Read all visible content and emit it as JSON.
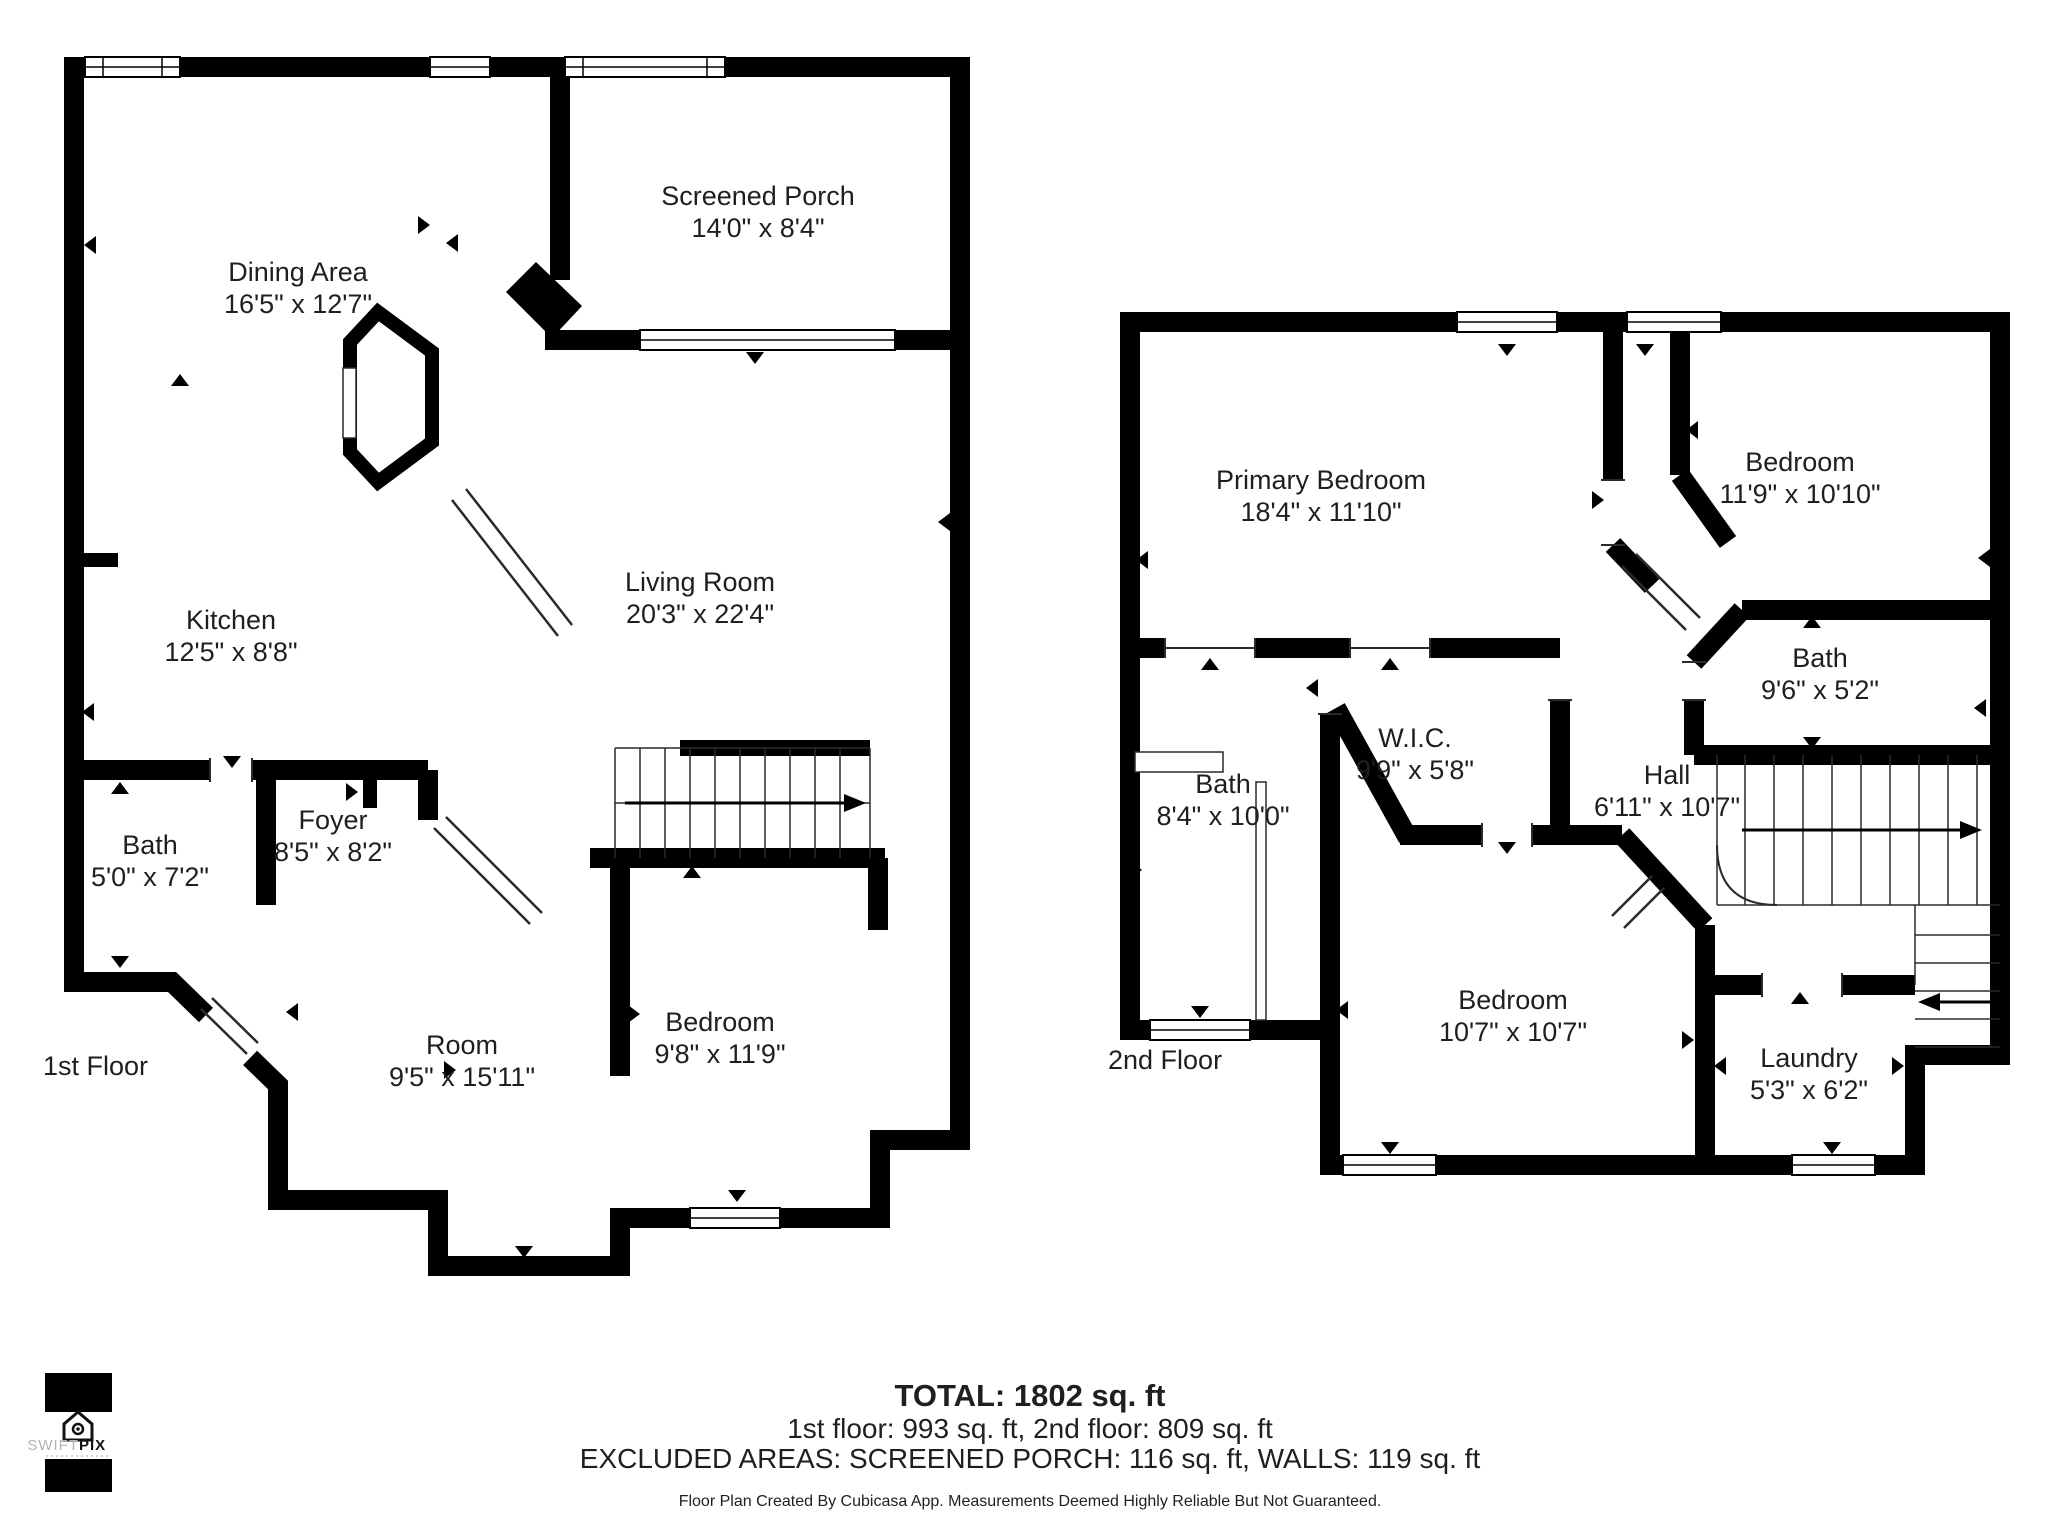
{
  "colors": {
    "wall": "#000000",
    "background": "#ffffff",
    "text": "#1f1f1f",
    "logo_light": "#b3b3b3"
  },
  "floors": [
    {
      "name": "1st Floor",
      "rooms": [
        {
          "label": "Dining Area",
          "dims": "16'5\" x 12'7\""
        },
        {
          "label": "Screened Porch",
          "dims": "14'0\" x 8'4\""
        },
        {
          "label": "Living Room",
          "dims": "20'3\" x 22'4\""
        },
        {
          "label": "Kitchen",
          "dims": "12'5\" x 8'8\""
        },
        {
          "label": "Bath",
          "dims": "5'0\" x 7'2\""
        },
        {
          "label": "Foyer",
          "dims": "8'5\" x 8'2\""
        },
        {
          "label": "Room",
          "dims": "9'5\" x 15'11\""
        },
        {
          "label": "Bedroom",
          "dims": "9'8\" x 11'9\""
        }
      ]
    },
    {
      "name": "2nd Floor",
      "rooms": [
        {
          "label": "Primary Bedroom",
          "dims": "18'4\" x 11'10\""
        },
        {
          "label": "Bedroom",
          "dims": "11'9\" x 10'10\""
        },
        {
          "label": "Bath",
          "dims": "9'6\" x 5'2\""
        },
        {
          "label": "W.I.C.",
          "dims": "9'9\" x 5'8\""
        },
        {
          "label": "Hall",
          "dims": "6'11\" x 10'7\""
        },
        {
          "label": "Bath",
          "dims": "8'4\" x 10'0\""
        },
        {
          "label": "Bedroom",
          "dims": "10'7\" x 10'7\""
        },
        {
          "label": "Laundry",
          "dims": "5'3\" x 6'2\""
        }
      ]
    }
  ],
  "summary": {
    "total": "TOTAL: 1802 sq. ft",
    "floors_breakdown": "1st floor: 993 sq. ft, 2nd floor: 809 sq. ft",
    "excluded": "EXCLUDED AREAS: SCREENED PORCH: 116 sq. ft, WALLS: 119 sq. ft",
    "disclaimer": "Floor Plan Created By Cubicasa App. Measurements Deemed Highly Reliable But Not Guaranteed."
  },
  "logo": {
    "brand_first": "SWIFT",
    "brand_second": "PIX"
  }
}
